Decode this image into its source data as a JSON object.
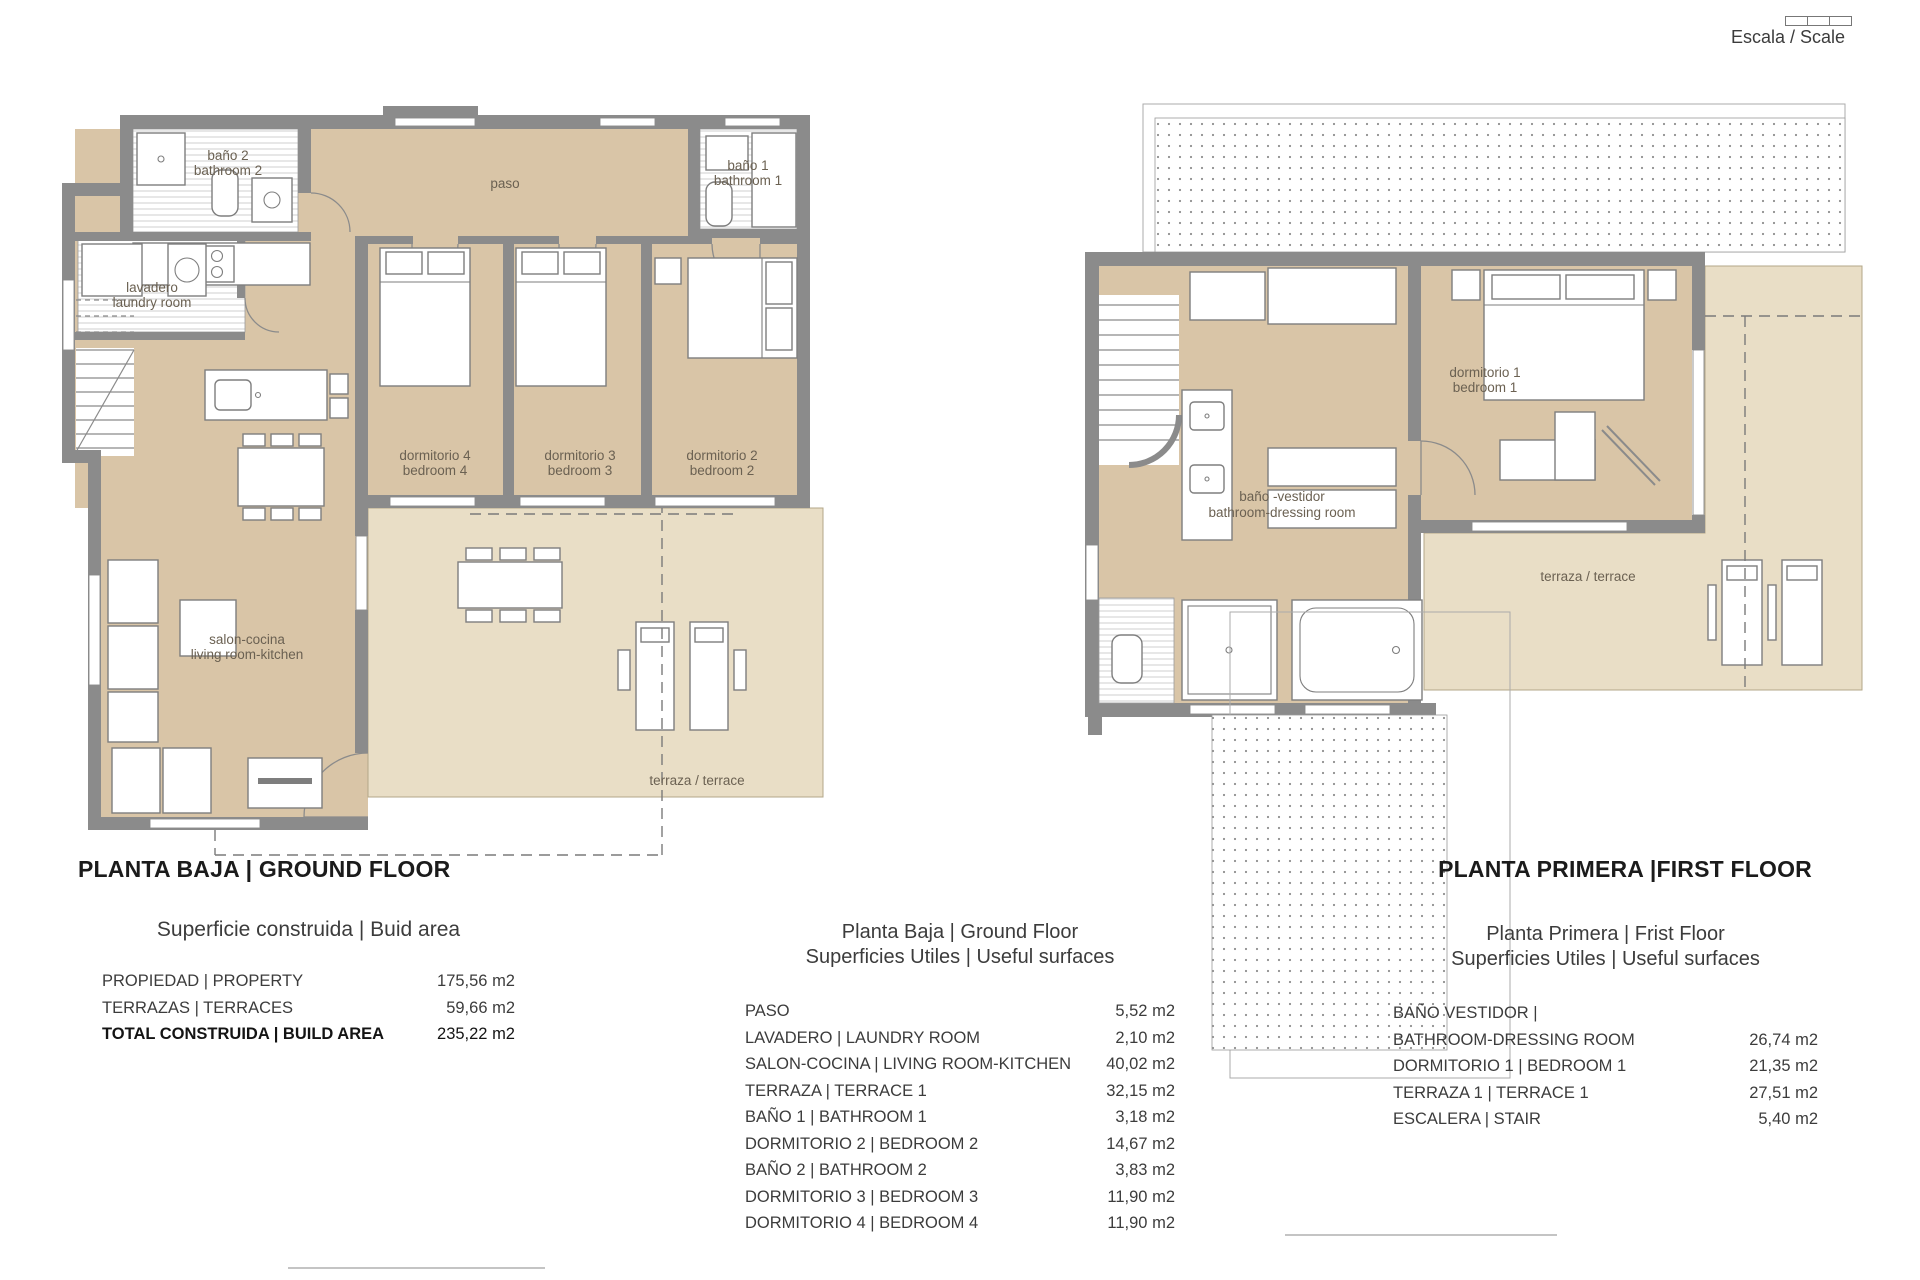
{
  "scale": {
    "label": "Escala / Scale"
  },
  "ground_floor": {
    "title": "PLANTA BAJA | GROUND FLOOR",
    "labels": {
      "bano2_1": "baño 2",
      "bano2_2": "bathroom 2",
      "bano1_1": "baño 1",
      "bano1_2": "bathroom 1",
      "lavadero_1": "lavadero",
      "lavadero_2": "laundry room",
      "paso": "paso",
      "dorm4_1": "dormitorio 4",
      "dorm4_2": "bedroom 4",
      "dorm3_1": "dormitorio 3",
      "dorm3_2": "bedroom 3",
      "dorm2_1": "dormitorio 2",
      "dorm2_2": "bedroom 2",
      "salon_1": "salon-cocina",
      "salon_2": "living room-kitchen",
      "terraza": "terraza / terrace"
    }
  },
  "first_floor": {
    "title": "PLANTA PRIMERA |FIRST FLOOR",
    "labels": {
      "dorm1_1": "dormitorio 1",
      "dorm1_2": "bedroom 1",
      "banov_1": "baño -vestidor",
      "banov_2": "bathroom-dressing room",
      "terraza": "terraza / terrace"
    }
  },
  "built_area_table": {
    "title": "Superficie construida | Buid area",
    "rows": [
      {
        "label": "PROPIEDAD | PROPERTY",
        "value": "175,56 m2"
      },
      {
        "label": "TERRAZAS | TERRACES",
        "value": "59,66 m2"
      },
      {
        "label": "TOTAL CONSTRUIDA | BUILD AREA",
        "value": "235,22 m2"
      }
    ]
  },
  "gf_useful_table": {
    "title_1": "Planta Baja | Ground Floor",
    "title_2": "Superficies Utiles | Useful surfaces",
    "rows": [
      {
        "label": "PASO",
        "value": "5,52 m2"
      },
      {
        "label": "LAVADERO | LAUNDRY ROOM",
        "value": "2,10 m2"
      },
      {
        "label": "SALON-COCINA | LIVING ROOM-KITCHEN",
        "value": "40,02 m2"
      },
      {
        "label": "TERRAZA | TERRACE 1",
        "value": "32,15 m2"
      },
      {
        "label": "BAÑO 1 | BATHROOM 1",
        "value": "3,18 m2"
      },
      {
        "label": "DORMITORIO 2 | BEDROOM 2",
        "value": "14,67 m2"
      },
      {
        "label": "BAÑO 2 | BATHROOM 2",
        "value": "3,83 m2"
      },
      {
        "label": "DORMITORIO 3 | BEDROOM 3",
        "value": "11,90 m2"
      },
      {
        "label": "DORMITORIO 4 | BEDROOM 4",
        "value": "11,90 m2"
      }
    ]
  },
  "ff_useful_table": {
    "title_1": "Planta Primera | Frist Floor",
    "title_2": "Superficies Utiles | Useful surfaces",
    "rows": [
      {
        "label": "BAÑO VESTIDOR |",
        "value": ""
      },
      {
        "label": "BATHROOM-DRESSING ROOM",
        "value": "26,74 m2"
      },
      {
        "label": "DORMITORIO 1 | BEDROOM 1",
        "value": "21,35 m2"
      },
      {
        "label": "TERRAZA 1 | TERRACE 1",
        "value": "27,51 m2"
      },
      {
        "label": "ESCALERA | STAIR",
        "value": "5,40 m2"
      }
    ]
  }
}
